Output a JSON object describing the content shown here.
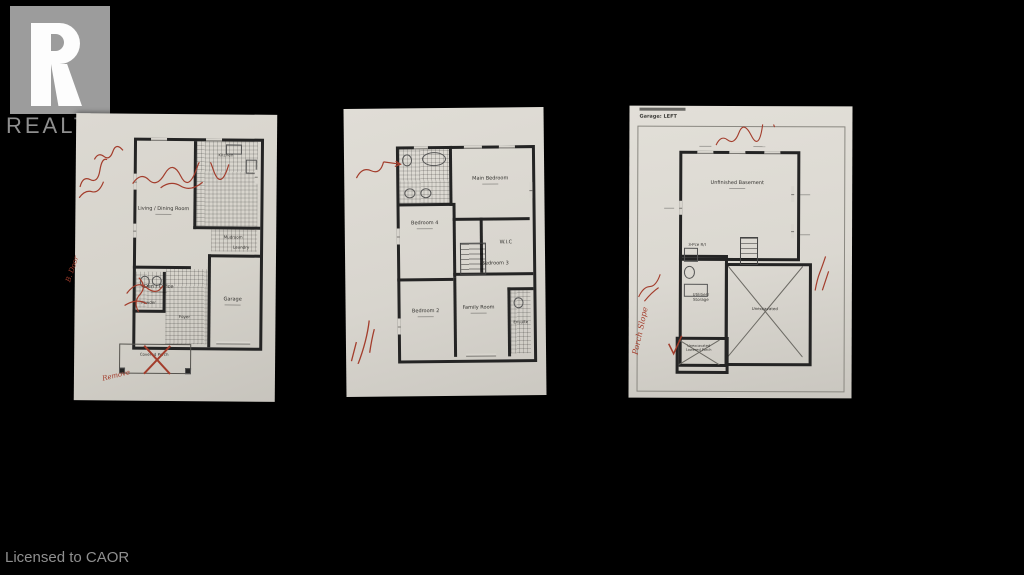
{
  "colors": {
    "background": "#000000",
    "paper": "#d8d5ce",
    "wall": "#242424",
    "annotation_red": "#a33d2c",
    "logo_gray": "#9c9c9c",
    "watermark_text": "#8f8f8f"
  },
  "branding": {
    "wordmark": "REALTOR",
    "registered": "®"
  },
  "footer": {
    "license": "Licensed to CAOR"
  },
  "plans": [
    {
      "name": "main-floor-plan",
      "rooms": {
        "living": "Living / Dining Room",
        "kitchen": "Kitchen",
        "mudroom": "Mudroom",
        "laundry": "Laundry",
        "den": "Den / Office",
        "powder": "Powder",
        "foyer": "Foyer",
        "garage": "Garage",
        "porch": "Covered Porch"
      },
      "annotations": {
        "remove": "Remove",
        "door": "B. Door"
      }
    },
    {
      "name": "second-floor-plan",
      "rooms": {
        "main_bedroom": "Main Bedroom",
        "ensuite": "Ensuite",
        "bedroom4": "Bedroom 4",
        "wic": "W.I.C",
        "bedroom3": "Bedroom 3",
        "bedroom2": "Bedroom 2",
        "family_room": "Family Room",
        "ensuite2": "Ensuite"
      }
    },
    {
      "name": "basement-plan",
      "header": "Garage: LEFT",
      "rooms": {
        "basement": "Unfinished Basement",
        "rough_in": "3-Pce R/I",
        "utilities": "Utilities/ Storage",
        "unexcavated": "Unexcavated",
        "porch": "Unexcavated Lowered Porch"
      },
      "annotations": {
        "porch_slope": "Porch Slope"
      }
    }
  ]
}
